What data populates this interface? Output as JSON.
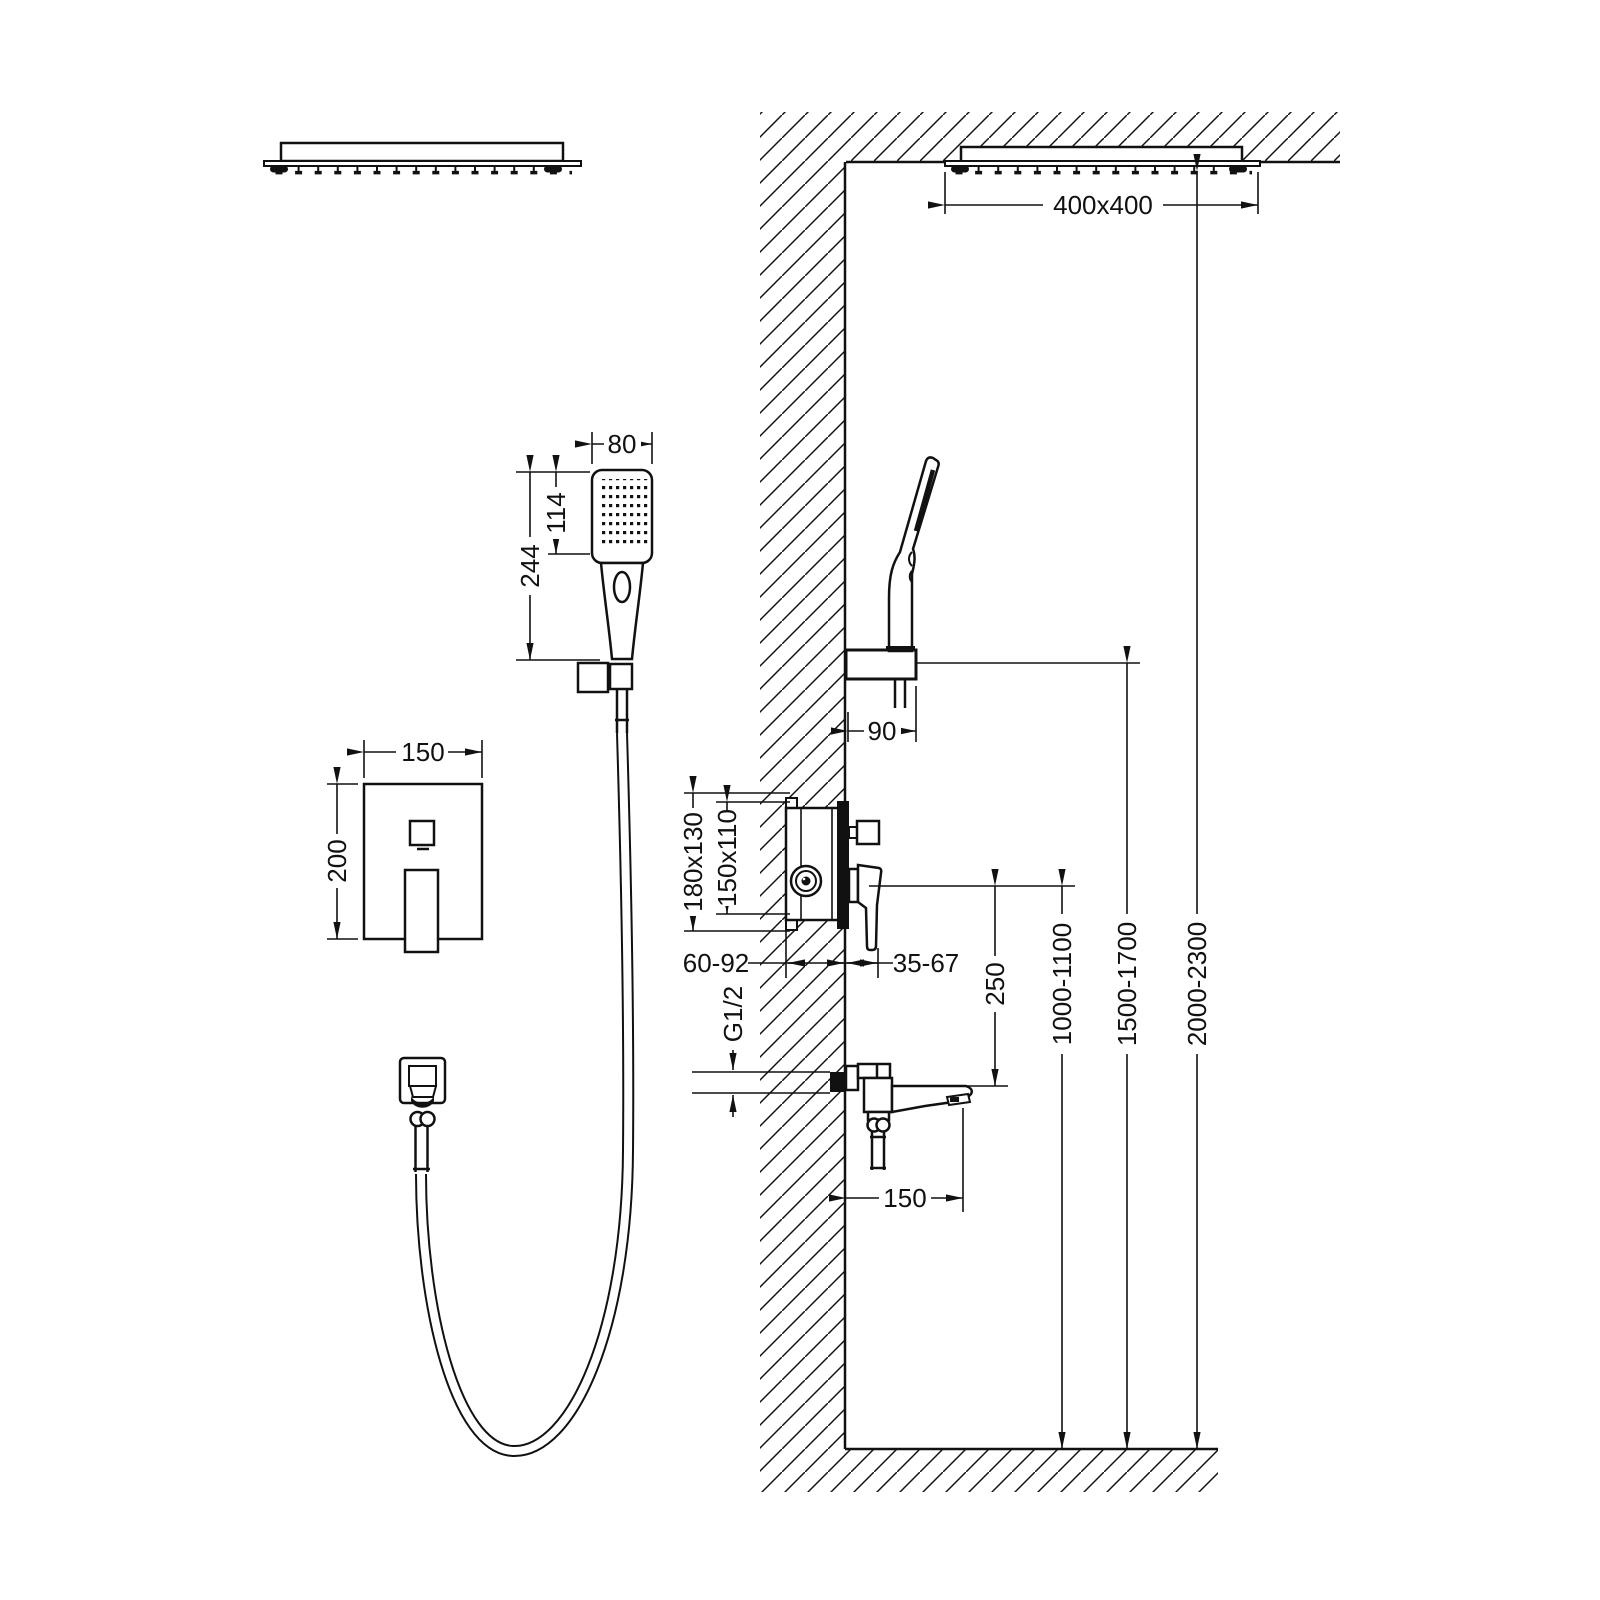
{
  "drawing": {
    "type": "shower-system-installation-diagram",
    "background": "#ffffff",
    "ink": "#111111",
    "dims": {
      "ceiling_head_size": "400x400",
      "hand_shower_width": "80",
      "hand_shower_head_length": "114",
      "hand_shower_length": "244",
      "plate_width": "150",
      "plate_height": "200",
      "holder_offset": "90",
      "valve_rough_opening": "180x130",
      "valve_box_size": "150x110",
      "valve_recess_depth": "60-92",
      "valve_protrusion": "35-67",
      "pipe_thread": "G1/2",
      "spout_length": "150",
      "spout_to_valve_height": "250",
      "valve_mount_height": "1000-1100",
      "holder_mount_height": "1500-1700",
      "ceiling_head_height": "2000-2300"
    }
  }
}
